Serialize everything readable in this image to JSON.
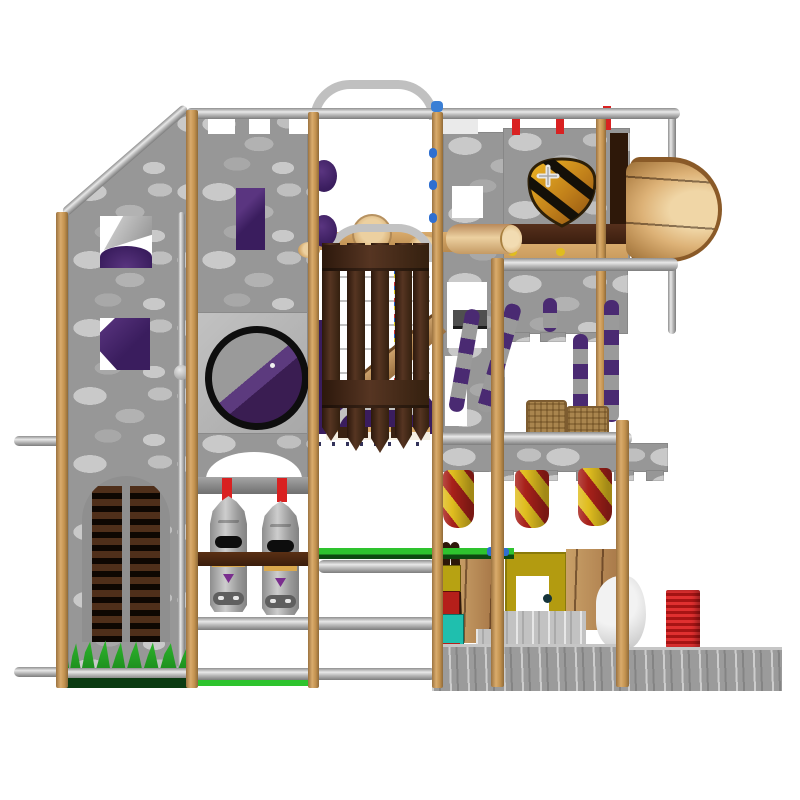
{
  "scene": {
    "kind": "3d-product-render",
    "subject": "castle-themed indoor soft-play playground structure, front elevation on white background",
    "text_content": "none"
  },
  "colors": {
    "stone-base": "#979797",
    "stone-light": "#c9c9c9",
    "stone-mid": "#b2b2b2",
    "stone-dim": "#a8a8a8",
    "wood-light": "#d9ab6c",
    "wood-dark": "#9c7340",
    "wood-edge": "#8f6a38",
    "steel-light": "#e8e8e8",
    "steel-mid": "#b9b9b9",
    "steel-dark": "#7d7d7d",
    "purple-dark": "#3a1d5e",
    "purple-mid": "#5a3580",
    "gate-brown": "#45291c",
    "gate-brown-dark": "#2c180c",
    "gate-brown-light": "#563522",
    "barrel-light": "#f0d6a6",
    "barrel-mid": "#ddb277",
    "barrel-dark": "#9c7038",
    "shield-gold": "#f0b824",
    "shield-amber": "#8a4f10",
    "stripe-black": "#141008",
    "red-accent": "#d92121",
    "bag-red": "#a8211a",
    "bag-yellow": "#e0bd1f",
    "pole-purple": "#4a2a72",
    "pole-gray": "#9a9a9a",
    "grass-green": "#2fbb2d",
    "grass-dark": "#0b3b12",
    "floor-green": "#2ec32e",
    "burlap": "#a9854e",
    "panel-yellow": "#b39b10",
    "block-teal": "#1fbfae",
    "block-red": "#b51f1a",
    "block-yellow": "#b7a212",
    "knight-silver": "#cdcdcd",
    "knight-trim": "#d9a84e",
    "base-gray": "#9b9b9b",
    "ledge-brown": "#56301c",
    "blue-cap": "#2f6fd0"
  },
  "parts": [
    "steel-top-rail",
    "steel-arch",
    "left-sloped-stone-wall",
    "crenellated-tower-wall",
    "purple-window-wedges",
    "porthole-panel",
    "portcullis-gate",
    "rope-climb-net",
    "wooden-slide",
    "roller-squeeze-arch",
    "grass-spikes",
    "knight-punch-bags",
    "shield-crest",
    "barrel-tunnel",
    "red-yellow-punch-bags",
    "purple-striped-climb-poles",
    "burlap-sacks",
    "yellow-play-door",
    "wood-plank-panels",
    "foam-block-stack",
    "stone-base-walls",
    "red-ribbed-block",
    "white-soft-sculpture"
  ]
}
